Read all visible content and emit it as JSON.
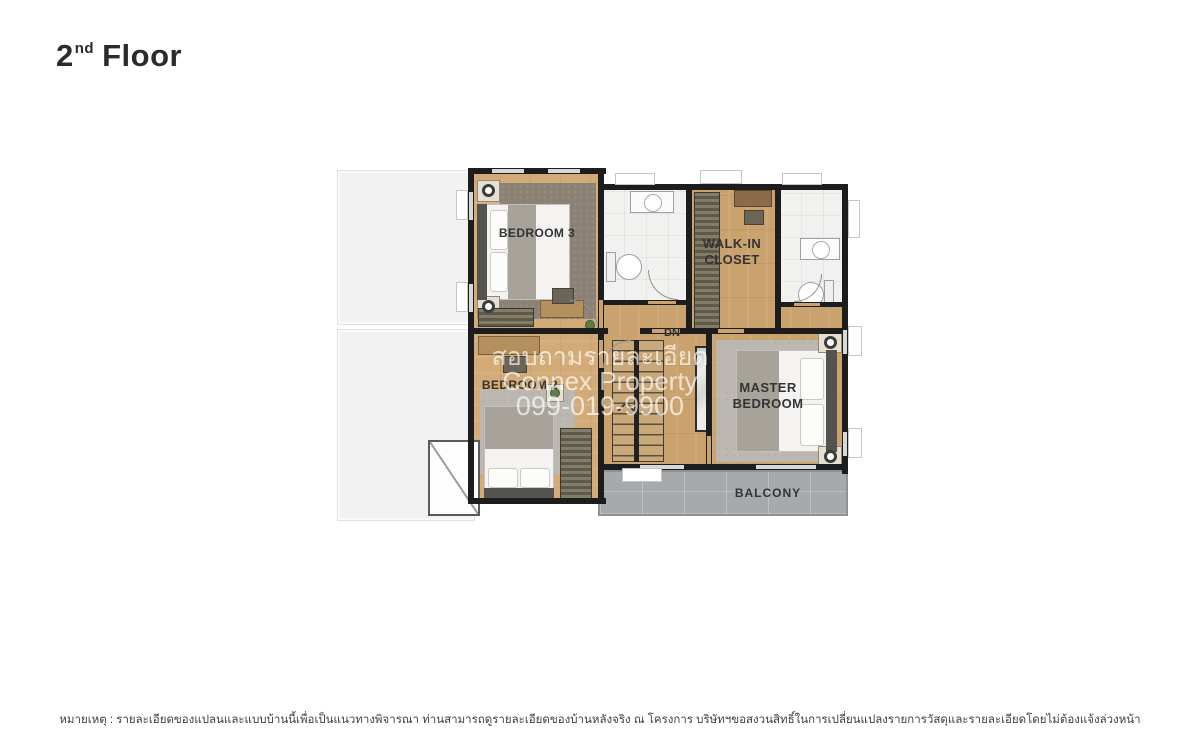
{
  "title": {
    "floor_number": "2",
    "ordinal_suffix": "nd",
    "floor_word": "Floor"
  },
  "watermark": {
    "line1": "สอบถามรายละเอียด",
    "line2": "Connex Property",
    "line3": "099-019-9900"
  },
  "plan": {
    "labels": {
      "bedroom3": "BEDROOM 3",
      "bedroom2": "BEDROOM 2",
      "walk_in_line1": "WALK-IN",
      "walk_in_line2": "CLOSET",
      "master_line1": "MASTER",
      "master_line2": "BEDROOM",
      "balcony": "BALCONY",
      "stairs_direction": "DN"
    }
  },
  "footer": {
    "note": "หมายเหตุ : รายละเอียดของแปลนและแบบบ้านนี้เพื่อเป็นแนวทางพิจารณา ท่านสามารถดูรายละเอียดของบ้านหลังจริง ณ โครงการ บริษัทฯขอสงวนสิทธิ์ในการเปลี่ยนแปลงรายการวัสดุและรายละเอียดโดยไม่ต้องแจ้งล่วงหน้า"
  },
  "colors": {
    "wall": "#1d1d1d",
    "wood": "#c9a26e",
    "wood-light": "#d2ab78",
    "bath": "#f1f1ef",
    "balcony": "#a6aaad",
    "rug-dark": "#8b8174",
    "rug-light": "#bcb8b1",
    "roof": "#f2f2f2",
    "label": "#333333"
  }
}
